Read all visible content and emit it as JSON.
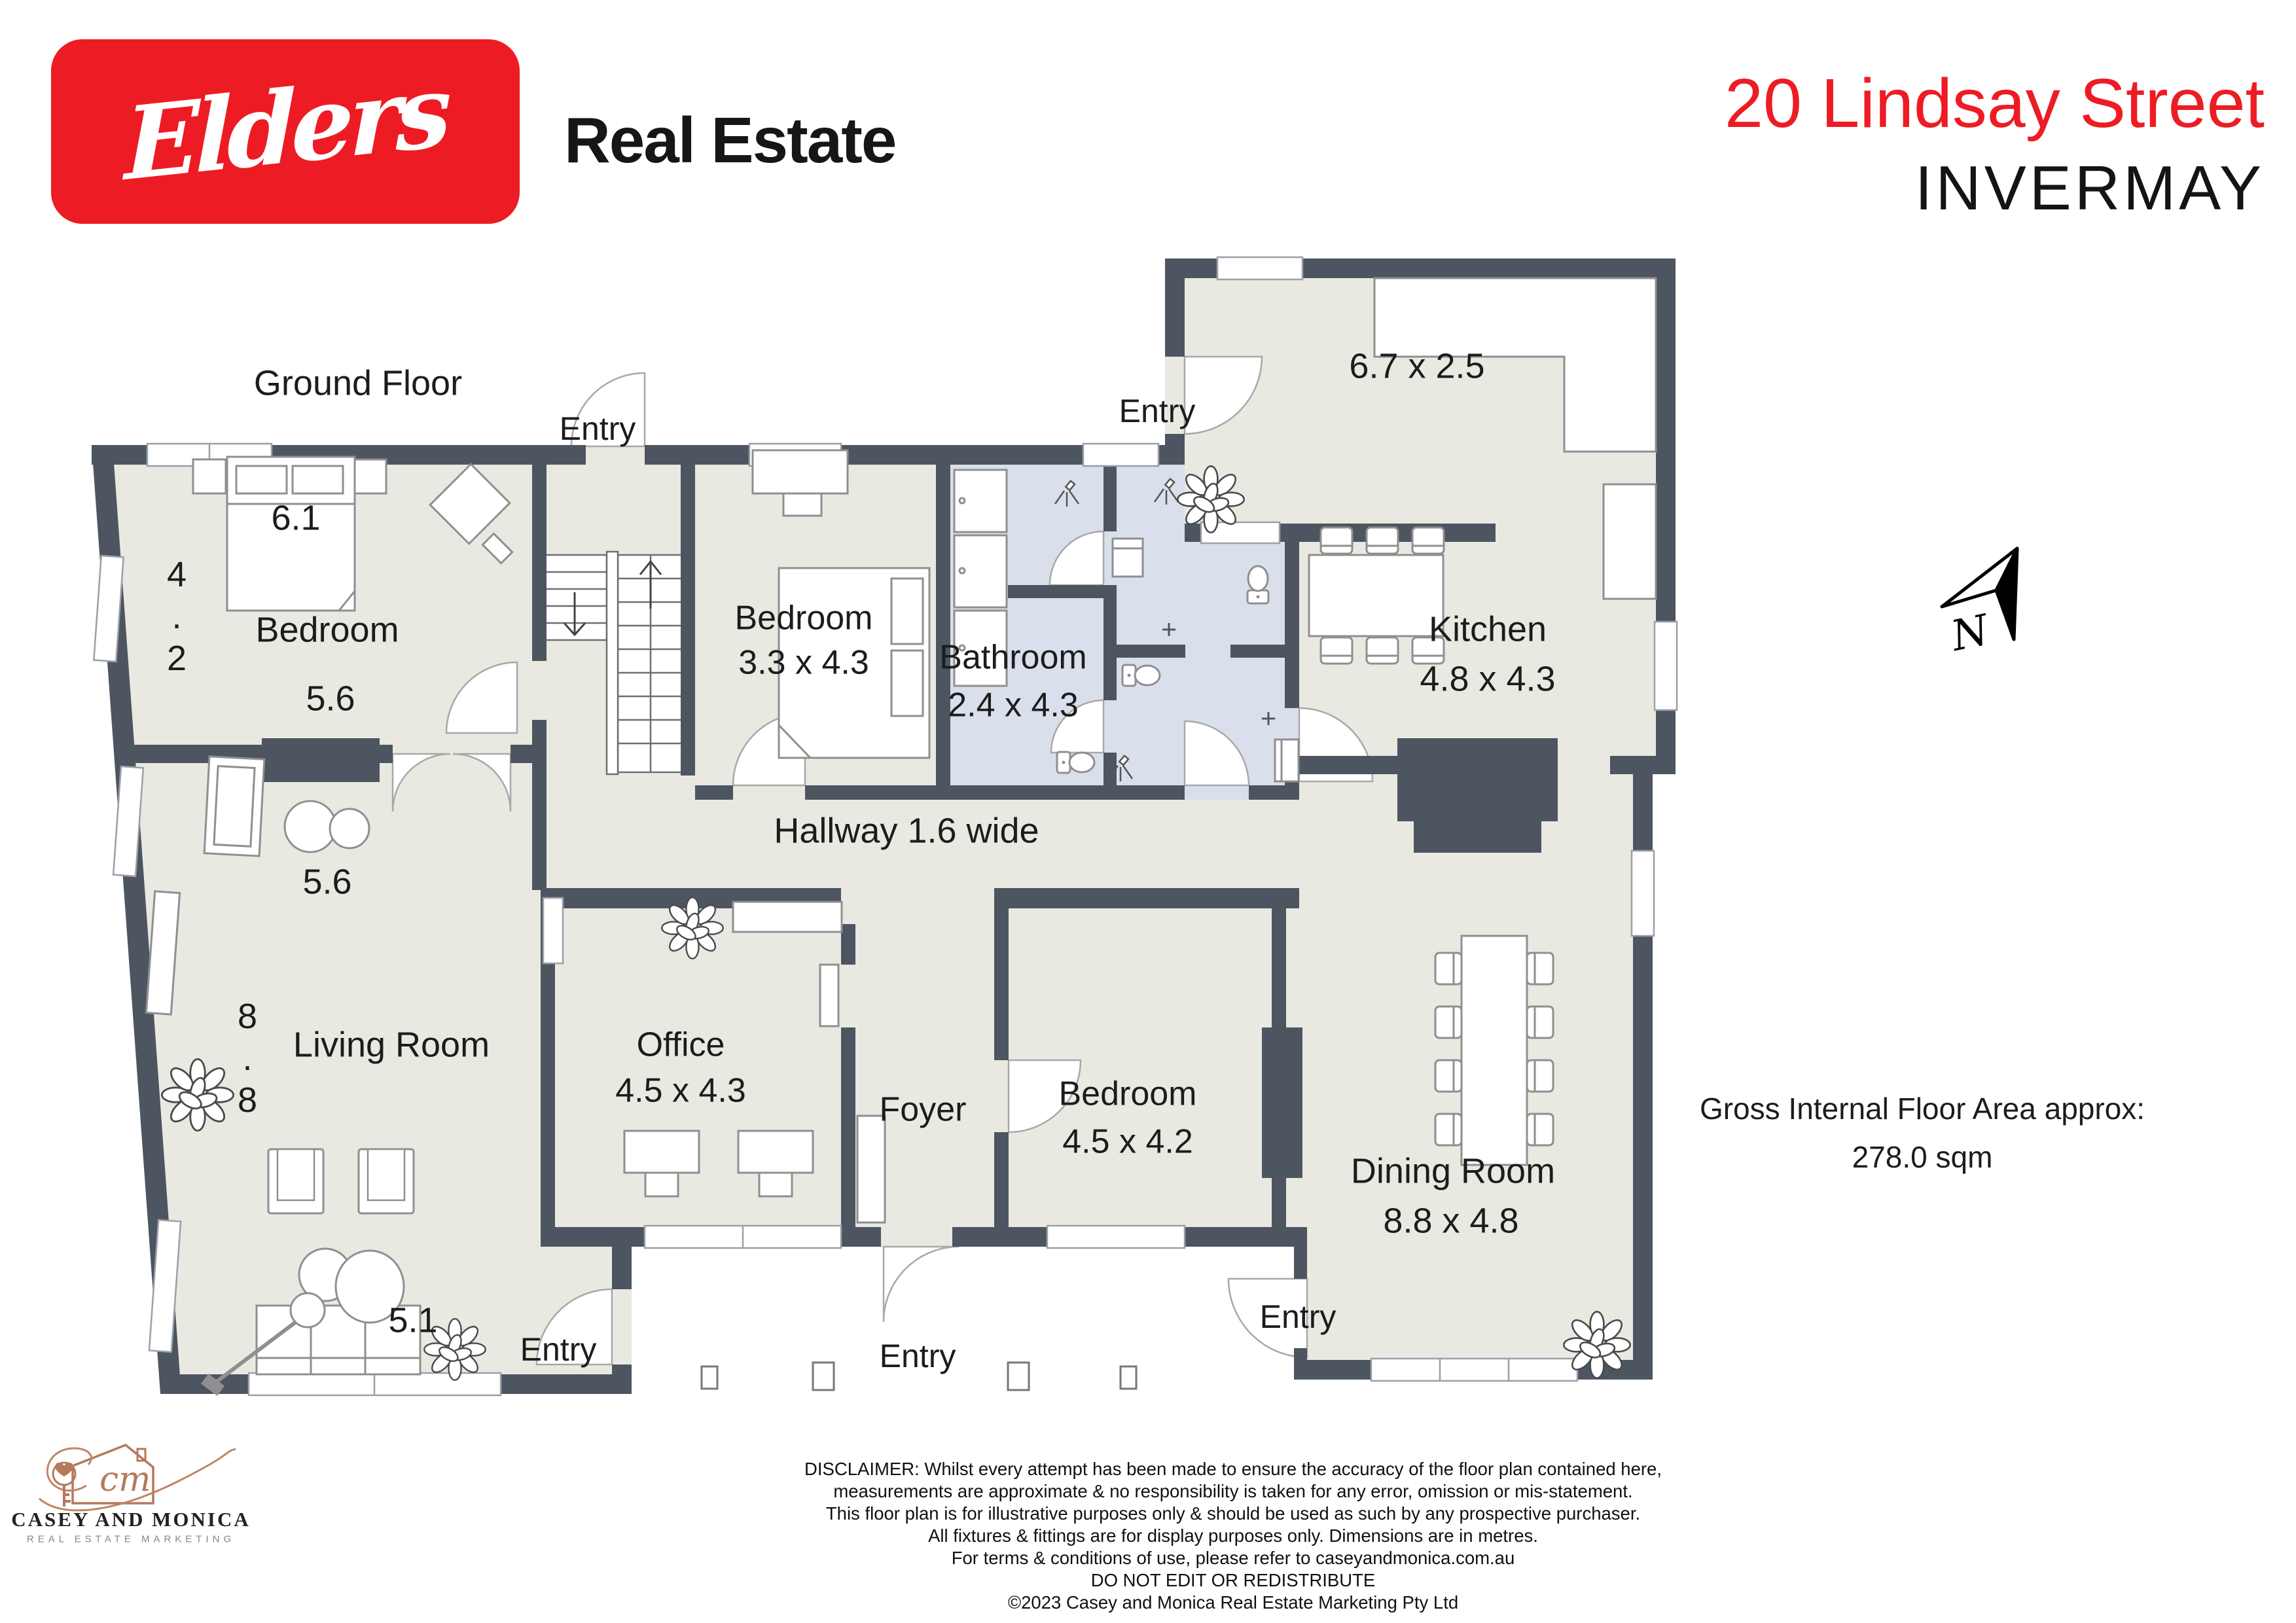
{
  "header": {
    "brand_script": "Elders",
    "brand_suffix": "Real Estate",
    "address_line1": "20 Lindsay Street",
    "address_line2": "INVERMAY"
  },
  "plan": {
    "floor_title": "Ground Floor",
    "entry_label": "Entry",
    "north_label": "N",
    "rooms": {
      "bedroom1": {
        "label": "Bedroom",
        "width": "6.1",
        "depth_digits": [
          "4",
          ".",
          "2"
        ],
        "inner_width": "5.6"
      },
      "bedroom2": {
        "label": "Bedroom",
        "dims": "3.3 x 4.3"
      },
      "bathroom": {
        "label": "Bathroom",
        "dims": "2.4 x 4.3"
      },
      "kitchen": {
        "label": "Kitchen",
        "dims": "4.8 x 4.3"
      },
      "laundry": {
        "dims": "6.7 x 2.5"
      },
      "hallway": {
        "label": "Hallway 1.6 wide"
      },
      "living": {
        "label": "Living Room",
        "top_dim": "5.6",
        "left_digits": [
          "8",
          ".",
          "8"
        ],
        "bottom_dim": "5.1"
      },
      "office": {
        "label": "Office",
        "dims": "4.5 x 4.3"
      },
      "foyer": {
        "label": "Foyer"
      },
      "bedroom3": {
        "label": "Bedroom",
        "dims": "4.5 x 4.2"
      },
      "dining": {
        "label": "Dining Room",
        "dims": "8.8 x 4.8"
      }
    },
    "area_note_line1": "Gross Internal Floor Area approx:",
    "area_note_line2": "278.0 sqm"
  },
  "footer": {
    "agency": {
      "name": "CASEY AND MONICA",
      "tagline": "REAL ESTATE MARKETING"
    },
    "disclaimer_lines": [
      "DISCLAIMER: Whilst every attempt has been made to ensure the accuracy of the floor plan contained here,",
      "measurements are approximate & no responsibility is taken for any error, omission or mis-statement.",
      "This floor plan is for illustrative purposes only & should be used as such by any prospective purchaser.",
      "All fixtures & fittings are for display purposes only. Dimensions are in metres.",
      "For terms & conditions of use, please refer to caseyandmonica.com.au",
      "DO NOT EDIT OR REDISTRIBUTE",
      "©2023 Casey and Monica Real Estate Marketing Pty Ltd"
    ]
  }
}
